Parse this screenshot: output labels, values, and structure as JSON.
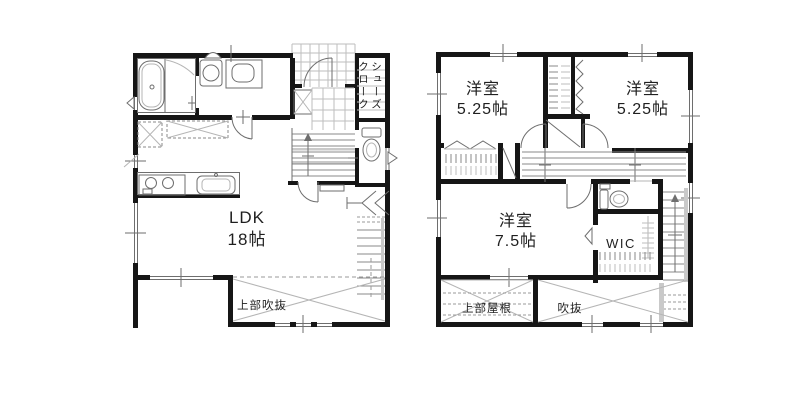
{
  "floor1": {
    "ldk_name": "LDK",
    "ldk_size": "18帖",
    "void_above": "上部吹抜",
    "shoes_closet_right_column": "シューズ",
    "shoes_closet_left_column": "クローク"
  },
  "floor2": {
    "room_top_left_name": "洋室",
    "room_top_left_size": "5.25帖",
    "room_top_right_name": "洋室",
    "room_top_right_size": "5.25帖",
    "room_main_name": "洋室",
    "room_main_size": "7.5帖",
    "wic": "WIC",
    "roof_above": "上部屋根",
    "void": "吹抜"
  },
  "colors": {
    "wall": "#161616",
    "line": "#6e6e6e",
    "light_line": "#b5b5b5",
    "text": "#1f1f1f",
    "background": "#ffffff"
  }
}
